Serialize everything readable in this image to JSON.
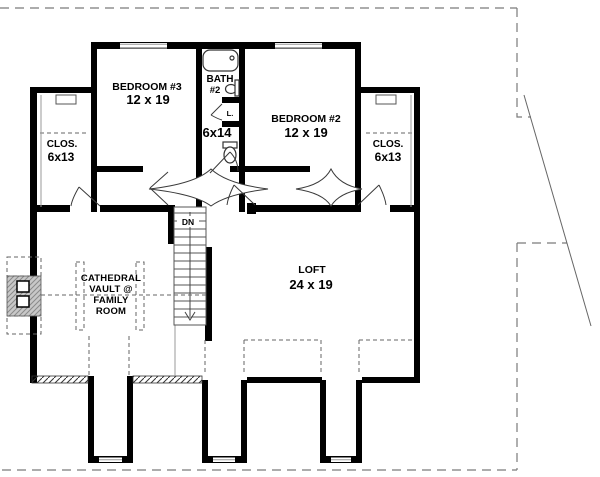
{
  "plan": {
    "bedroom3": {
      "name": "BEDROOM #3",
      "dims": "12 x 19"
    },
    "bath": {
      "name_line1": "BATH",
      "name_line2": "#2",
      "dims": "6x14",
      "linen_label": "L."
    },
    "bedroom2": {
      "name": "BEDROOM #2",
      "dims": "12 x 19"
    },
    "closet_left": {
      "name": "CLOS.",
      "dims": "6x13"
    },
    "closet_right": {
      "name": "CLOS.",
      "dims": "6x13"
    },
    "loft": {
      "name": "LOFT",
      "dims": "24 x 19"
    },
    "family_room": {
      "line1": "CATHEDRAL",
      "line2": "VAULT @",
      "line3": "FAMILY",
      "line4": "ROOM"
    },
    "stairs": {
      "label": "DN"
    }
  },
  "colors": {
    "walls": "#000000",
    "thin_lines": "#555555",
    "dashed_lines": "#7a7a7a",
    "fireplace_fill": "#c8c8c8",
    "background": "#ffffff"
  }
}
